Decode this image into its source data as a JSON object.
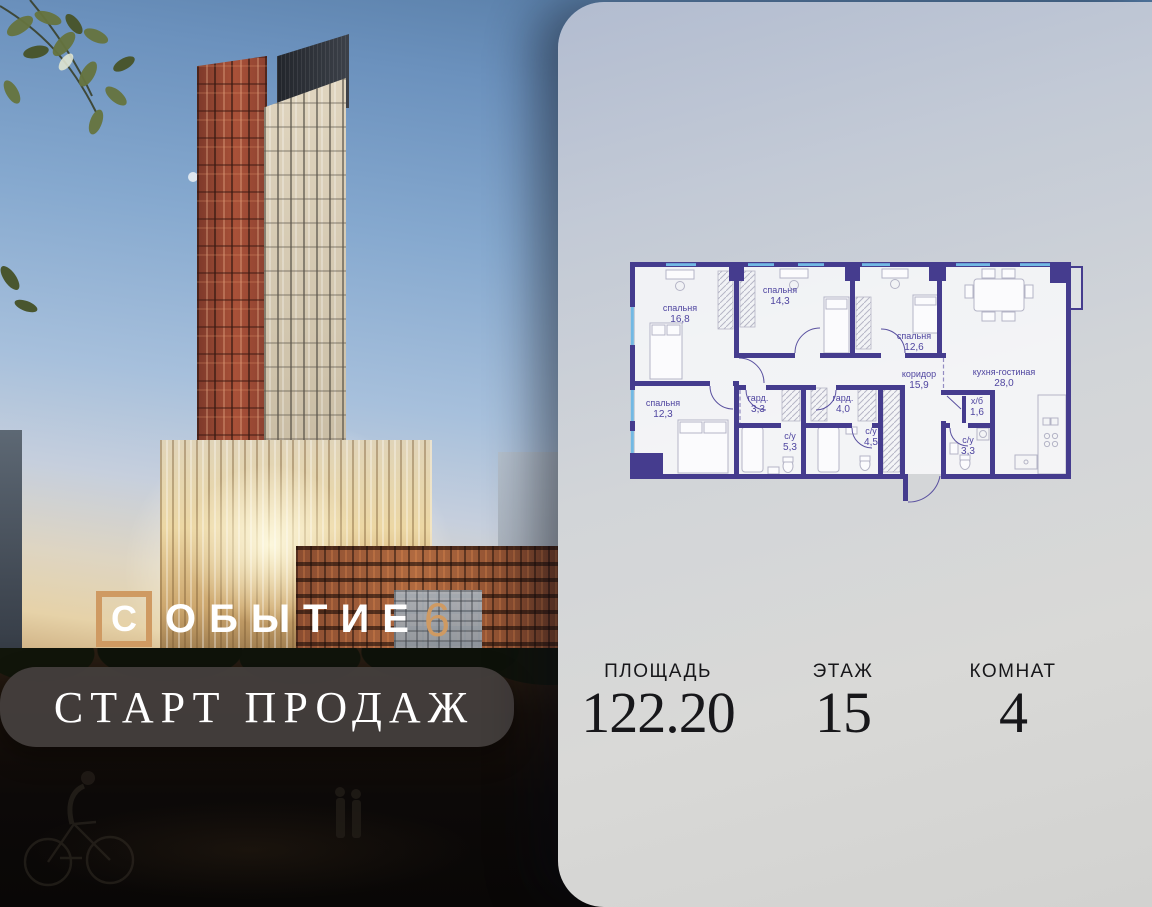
{
  "brand": {
    "name_first_letter": "С",
    "name_rest": "ОБЫТИЕ",
    "number": "6"
  },
  "banner": {
    "text": "СТАРТ ПРОДАЖ"
  },
  "floorplan": {
    "rooms": [
      {
        "name": "спальня",
        "area": "16,8"
      },
      {
        "name": "спальня",
        "area": "14,3"
      },
      {
        "name": "спальня",
        "area": "12,6"
      },
      {
        "name": "кухня-гостиная",
        "area": "28,0"
      },
      {
        "name": "коридор",
        "area": "15,9"
      },
      {
        "name": "спальня",
        "area": "12,3"
      },
      {
        "name": "гард.",
        "area": "3,3"
      },
      {
        "name": "гард.",
        "area": "4,0"
      },
      {
        "name": "с/у",
        "area": "5,3"
      },
      {
        "name": "с/у",
        "area": "4,5"
      },
      {
        "name": "х/б",
        "area": "1,6"
      },
      {
        "name": "с/у",
        "area": "3,3"
      }
    ]
  },
  "stats": [
    {
      "label": "ПЛОЩАДЬ",
      "value": "122.20"
    },
    {
      "label": "ЭТАЖ",
      "value": "15"
    },
    {
      "label": "КОМНАТ",
      "value": "4"
    }
  ],
  "colors": {
    "accent_gold": "#cf9a62",
    "plan_wall": "#453c8e",
    "plan_window": "#72b9e4",
    "banner_bg": "#45403e"
  }
}
